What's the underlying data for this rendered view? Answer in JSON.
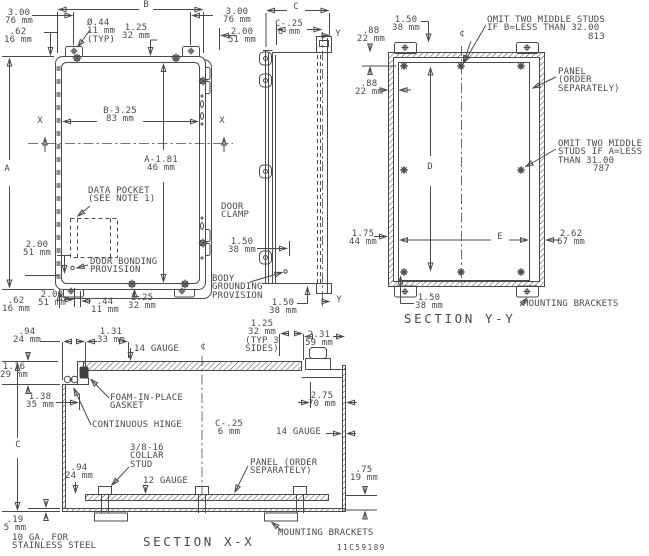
{
  "drawing": {
    "number": "11C59189",
    "colors": {
      "line": "#4a4a4a",
      "text": "#4a4a4a",
      "background": "#ffffff"
    },
    "section_titles": {
      "yy": "SECTION Y-Y",
      "xx": "SECTION X-X"
    },
    "labels": [
      {
        "n": "dim-b-letter",
        "x": 146,
        "y": 1,
        "a": "c",
        "t": "B"
      },
      {
        "n": "dim-300-top-left",
        "x": 19,
        "y": 9,
        "a": "c",
        "t": "3.00\n76 mm"
      },
      {
        "n": "dim-62-top-left",
        "x": 18,
        "y": 28,
        "a": "c",
        "t": ".62\n16 mm"
      },
      {
        "n": "dim-dia-44-typ",
        "x": 87,
        "y": 19,
        "a": "l",
        "t": "Ø.44\n11 mm\n(TYP)"
      },
      {
        "n": "dim-125-top",
        "x": 136,
        "y": 24,
        "a": "c",
        "t": "1.25\n32 mm"
      },
      {
        "n": "dim-300-top-right",
        "x": 237,
        "y": 8,
        "a": "c",
        "t": "3.00\n76 mm"
      },
      {
        "n": "dim-200-top-right",
        "x": 242,
        "y": 28,
        "a": "c",
        "t": "2.00\n51 mm"
      },
      {
        "n": "dim-b-325",
        "x": 120,
        "y": 107,
        "a": "c",
        "t": "B-3.25\n83 mm"
      },
      {
        "n": "x-mark-left",
        "x": 40,
        "y": 117,
        "a": "c",
        "t": "X"
      },
      {
        "n": "x-mark-right",
        "x": 222,
        "y": 117,
        "a": "c",
        "t": "X"
      },
      {
        "n": "dim-a-letter",
        "x": 7,
        "y": 165,
        "a": "c",
        "t": "A"
      },
      {
        "n": "dim-a-181",
        "x": 161,
        "y": 156,
        "a": "c",
        "t": "A-1.81\n46 mm"
      },
      {
        "n": "note-data-pocket",
        "x": 88,
        "y": 187,
        "a": "l",
        "t": "DATA POCKET\n(SEE NOTE 1)"
      },
      {
        "n": "dim-200-left-mid",
        "x": 37,
        "y": 241,
        "a": "c",
        "t": "2.00\n51 mm"
      },
      {
        "n": "note-door-bonding",
        "x": 90,
        "y": 258,
        "a": "l",
        "t": "DOOR BONDING\nPROVISION"
      },
      {
        "n": "dim-62-bottom",
        "x": 16,
        "y": 297,
        "a": "c",
        "t": ".62\n16 mm"
      },
      {
        "n": "dim-200-bottom",
        "x": 52,
        "y": 291,
        "a": "c",
        "t": "2.00\n51 mm"
      },
      {
        "n": "dim-44-bottom",
        "x": 105,
        "y": 298,
        "a": "c",
        "t": ".44\n11 mm"
      },
      {
        "n": "dim-125-bottom",
        "x": 142,
        "y": 294,
        "a": "c",
        "t": "1.25\n32 mm"
      },
      {
        "n": "dim-c-top",
        "x": 296,
        "y": 3,
        "a": "c",
        "t": "C"
      },
      {
        "n": "dim-c-25-top",
        "x": 289,
        "y": 20,
        "a": "c",
        "t": "C-.25\n6 mm"
      },
      {
        "n": "y-mark-top",
        "x": 338,
        "y": 30,
        "a": "c",
        "t": "Y"
      },
      {
        "n": "note-door-clamp",
        "x": 221,
        "y": 203,
        "a": "l",
        "t": "DOOR\nCLAMP"
      },
      {
        "n": "dim-150-clamp",
        "x": 242,
        "y": 238,
        "a": "c",
        "t": "1.50\n38 mm"
      },
      {
        "n": "note-body-grounding",
        "x": 212,
        "y": 275,
        "a": "l",
        "t": "BODY\nGROUNDING\nPROVISION"
      },
      {
        "n": "dim-150-side-bottom",
        "x": 283,
        "y": 299,
        "a": "c",
        "t": "1.50\n38 mm"
      },
      {
        "n": "y-mark-bottom",
        "x": 339,
        "y": 296,
        "a": "c",
        "t": "Y"
      },
      {
        "n": "dim-175-44",
        "x": 363,
        "y": 230,
        "a": "c",
        "t": "1.75\n44 mm"
      },
      {
        "n": "dim-150-yy-top",
        "x": 406,
        "y": 16,
        "a": "c",
        "t": "1.50\n38 mm"
      },
      {
        "n": "dim-88-yy-vert",
        "x": 371,
        "y": 27,
        "a": "c",
        "t": ".88\n22 mm"
      },
      {
        "n": "dim-88-yy-horiz",
        "x": 369,
        "y": 80,
        "a": "c",
        "t": ".88\n22 mm"
      },
      {
        "n": "centerline-symbol-yy",
        "x": 462,
        "y": 30,
        "a": "c",
        "t": "¢"
      },
      {
        "n": "note-omit-b",
        "x": 487,
        "y": 16,
        "a": "l",
        "t": "OMIT TWO MIDDLE STUDS\nIF B=LESS THAN 32.00"
      },
      {
        "n": "note-omit-b-mm",
        "x": 588,
        "y": 33,
        "a": "l",
        "t": "813"
      },
      {
        "n": "note-panel-yy",
        "x": 558,
        "y": 68,
        "a": "l",
        "t": "PANEL\n(ORDER\nSEPARATELY)"
      },
      {
        "n": "note-omit-a",
        "x": 558,
        "y": 140,
        "a": "l",
        "t": "OMIT TWO MIDDLE\nSTUDS IF A=LESS\nTHAN 31.00"
      },
      {
        "n": "note-omit-a-mm",
        "x": 593,
        "y": 165,
        "a": "l",
        "t": "787"
      },
      {
        "n": "dim-d-letter",
        "x": 430,
        "y": 163,
        "a": "c",
        "t": "D"
      },
      {
        "n": "dim-e-letter",
        "x": 500,
        "y": 233,
        "a": "c",
        "t": "E"
      },
      {
        "n": "dim-262-67",
        "x": 571,
        "y": 230,
        "a": "c",
        "t": "2.62\n67 mm"
      },
      {
        "n": "dim-150-yy-bottom",
        "x": 429,
        "y": 294,
        "a": "c",
        "t": "1.50\n38 mm"
      },
      {
        "n": "note-mounting-brackets-yy",
        "x": 523,
        "y": 300,
        "a": "l",
        "t": "MOUNTING BRACKETS"
      },
      {
        "n": "title-section-yy",
        "x": 404,
        "y": 312,
        "a": "l",
        "t": "SECTION Y-Y",
        "s": "title"
      },
      {
        "n": "dim-94-xx-top",
        "x": 27,
        "y": 328,
        "a": "c",
        "t": ".94\n24 mm"
      },
      {
        "n": "dim-131-33",
        "x": 111,
        "y": 328,
        "a": "c",
        "t": "1.31\n33 mm"
      },
      {
        "n": "note-14-gauge-top",
        "x": 134,
        "y": 345,
        "a": "l",
        "t": "14 GAUGE"
      },
      {
        "n": "centerline-symbol-xx",
        "x": 203,
        "y": 343,
        "a": "c",
        "t": "¢"
      },
      {
        "n": "dim-116-29",
        "x": 14,
        "y": 363,
        "a": "c",
        "t": "1.16\n29 mm"
      },
      {
        "n": "dim-138-35",
        "x": 40,
        "y": 393,
        "a": "c",
        "t": "1.38\n35 mm"
      },
      {
        "n": "note-foam-gasket",
        "x": 110,
        "y": 394,
        "a": "l",
        "t": "FOAM-IN-PLACE\nGASKET"
      },
      {
        "n": "note-continuous-hinge",
        "x": 92,
        "y": 421,
        "a": "l",
        "t": "CONTINUOUS HINGE"
      },
      {
        "n": "dim-125-typ-3-sides",
        "x": 262,
        "y": 320,
        "a": "c",
        "t": "1.25\n32 mm\n(TYP 3\nSIDES)"
      },
      {
        "n": "dim-231-59",
        "x": 319,
        "y": 331,
        "a": "c",
        "t": "2.31\n59 mm"
      },
      {
        "n": "dim-275-70",
        "x": 322,
        "y": 392,
        "a": "c",
        "t": "2.75\n70 mm"
      },
      {
        "n": "dim-c-xx",
        "x": 18,
        "y": 441,
        "a": "c",
        "t": "C"
      },
      {
        "n": "dim-c-25-xx",
        "x": 229,
        "y": 420,
        "a": "c",
        "t": "C-.25\n6 mm"
      },
      {
        "n": "note-14-gauge-right",
        "x": 276,
        "y": 428,
        "a": "l",
        "t": "14 GAUGE"
      },
      {
        "n": "note-collar-stud",
        "x": 130,
        "y": 444,
        "a": "l",
        "t": "3/8-16\nCOLLAR\nSTUD"
      },
      {
        "n": "dim-94-xx-bottom",
        "x": 79,
        "y": 464,
        "a": "c",
        "t": ".94\n24 mm"
      },
      {
        "n": "note-12-gauge",
        "x": 143,
        "y": 477,
        "a": "l",
        "t": "12 GAUGE"
      },
      {
        "n": "note-panel-xx",
        "x": 250,
        "y": 459,
        "a": "l",
        "t": "PANEL (ORDER\nSEPARATELY)"
      },
      {
        "n": "dim-75-19",
        "x": 364,
        "y": 466,
        "a": "c",
        "t": ".75\n19 mm"
      },
      {
        "n": "dim-19-5",
        "x": 15,
        "y": 516,
        "a": "c",
        "t": ".19\n5 mm"
      },
      {
        "n": "note-10-ga-stainless",
        "x": 12,
        "y": 534,
        "a": "l",
        "t": "10 GA. FOR\nSTAINLESS STEEL"
      },
      {
        "n": "note-mounting-brackets-xx",
        "x": 278,
        "y": 529,
        "a": "l",
        "t": "MOUNTING BRACKETS"
      },
      {
        "n": "title-section-xx",
        "x": 143,
        "y": 535,
        "a": "l",
        "t": "SECTION X-X",
        "s": "title"
      },
      {
        "n": "drawing-number",
        "x": 337,
        "y": 544,
        "a": "l",
        "t": "11C59189",
        "s": "tiny"
      }
    ]
  }
}
